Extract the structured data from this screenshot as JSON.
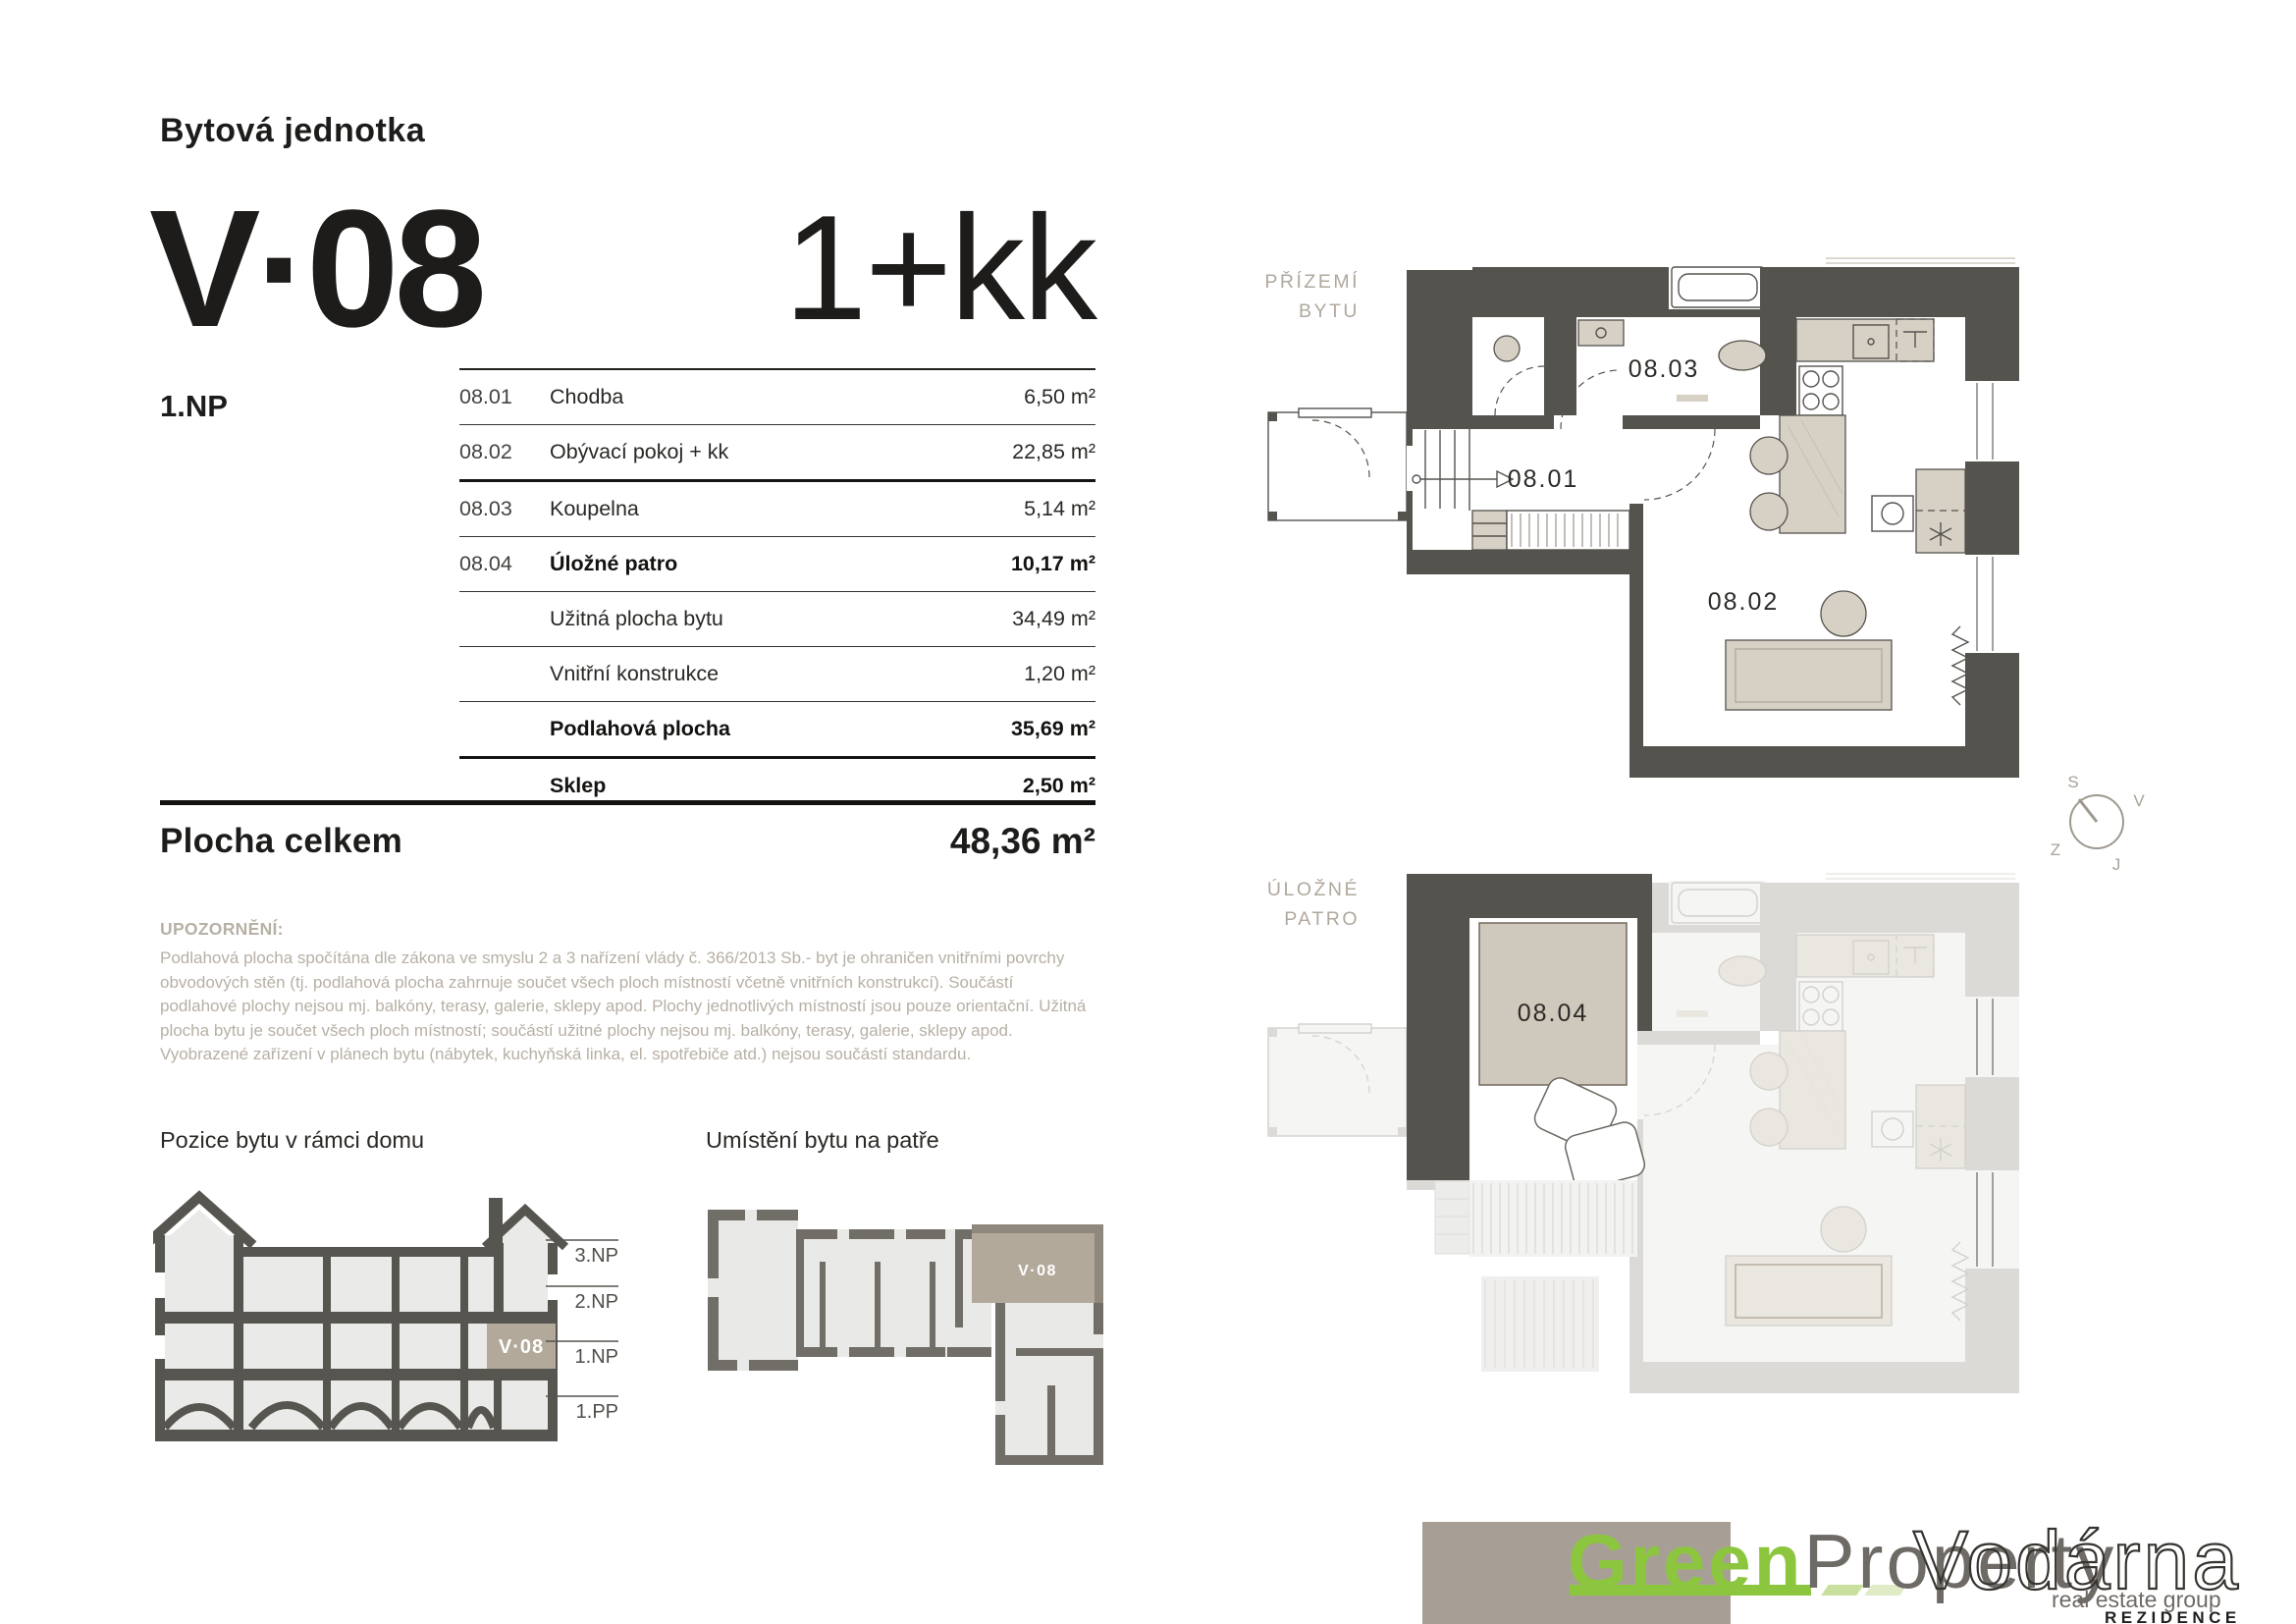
{
  "header": {
    "doc_title": "Bytová jednotka",
    "unit_code": "V·08",
    "unit_type": "1+kk",
    "floor_label": "1.NP"
  },
  "area_table": {
    "rows": [
      {
        "code": "08.01",
        "name": "Chodba",
        "value": "6,50 m²"
      },
      {
        "code": "08.02",
        "name": "Obývací pokoj + kk",
        "value": "22,85 m²"
      },
      {
        "code": "08.03",
        "name": "Koupelna",
        "value": "5,14 m²"
      },
      {
        "code": "08.04",
        "name": "Úložné patro",
        "value": "10,17 m²"
      },
      {
        "code": "",
        "name": "Užitná plocha bytu",
        "value": "34,49 m²"
      },
      {
        "code": "",
        "name": "Vnitřní konstrukce",
        "value": "1,20 m²"
      },
      {
        "code": "",
        "name": "Podlahová plocha",
        "value": "35,69 m²"
      },
      {
        "code": "",
        "name": "Sklep",
        "value": "2,50 m²"
      }
    ],
    "total_label": "Plocha celkem",
    "total_value": "48,36 m²"
  },
  "disclaimer": {
    "title": "UPOZORNĚNÍ:",
    "body": "Podlahová plocha spočítána dle zákona ve smyslu 2 a 3 nařízení vlády č. 366/2013 Sb.- byt je ohraničen vnitřními povrchy obvodových stěn (tj. podlahová plocha zahrnuje součet všech ploch místností včetně vnitřních konstrukcí). Součástí podlahové plochy nejsou mj. balkóny, terasy, galerie, sklepy apod. Plochy jednotlivých místností jsou pouze orientační. Užitná plocha bytu je součet všech ploch místností; součástí užitné plochy nejsou mj. balkóny, terasy, galerie, sklepy apod. Vyobrazené zařízení v plánech bytu (nábytek, kuchyňská linka, el. spotřebiče atd.) nejsou součástí standardu."
  },
  "position_section": {
    "title": "Pozice bytu v rámci domu",
    "levels": [
      "3.NP",
      "2.NP",
      "1.NP",
      "1.PP"
    ],
    "unit_label": "V·08"
  },
  "floor_plan_section": {
    "title": "Umístění bytu na patře",
    "unit_label": "V·08"
  },
  "plans": {
    "ground": {
      "title_line1": "PŘÍZEMÍ",
      "title_line2": "BYTU",
      "room_01": "08.01",
      "room_02": "08.02",
      "room_03": "08.03"
    },
    "storage": {
      "title_line1": "ÚLOŽNÉ",
      "title_line2": "PATRO",
      "room_04": "08.04"
    }
  },
  "compass": {
    "north": "S",
    "east": "V",
    "south": "J",
    "west": "Z"
  },
  "logo": {
    "green": "Green",
    "property": "Property",
    "tagline": "real estate group",
    "project": "Vodárna",
    "project_sub": "REZIDENCE"
  },
  "colors": {
    "accent_green": "#8cc63e",
    "wall_dark": "#55534e",
    "taupe_highlight": "#b2a99b",
    "furniture": "#d6d0c5",
    "muted_text": "#b7b0a5",
    "logo_gray": "#6e6a66",
    "band": "#a79f96"
  }
}
